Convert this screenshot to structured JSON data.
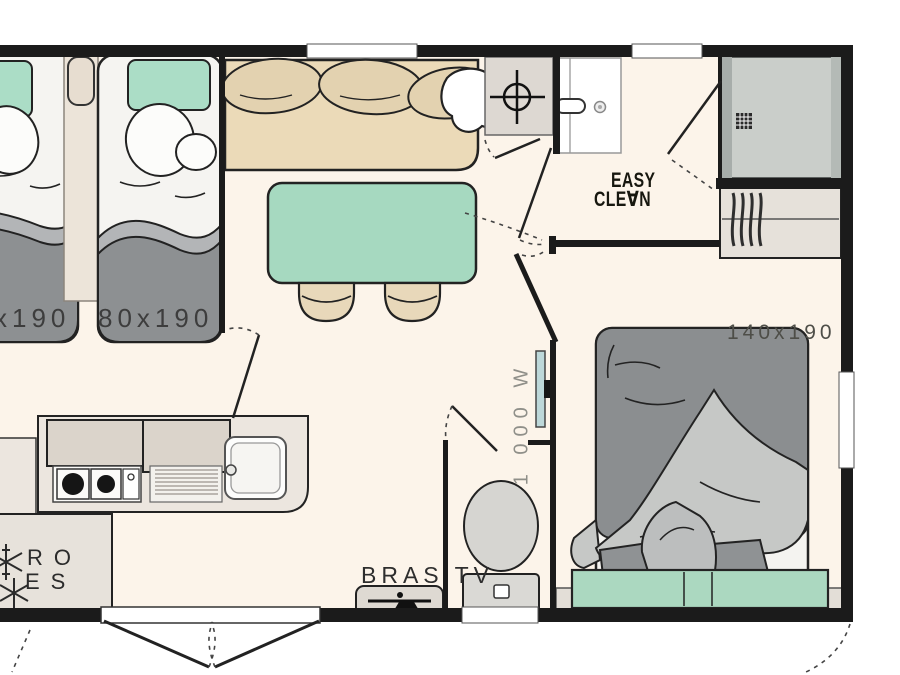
{
  "plan": {
    "title": "mobile-home floor plan",
    "labels": {
      "bed_left_size": "x190",
      "bed_right_size": "80x190",
      "double_bed_size": "140x190",
      "easy_clean_top": "EASY",
      "easy_clean_bottom": "CLE∀N",
      "heater_power": "1 000 W",
      "tv_bracket": "BRAS TV",
      "appliance_line1": "RO",
      "appliance_line2": "ES"
    },
    "colors": {
      "wall": "#1b1b1b",
      "floor": "#fcf4ea",
      "teal": "#a6d9c0",
      "sofa_beige": "#ebdab8",
      "bolster_beige": "#e3d2b0",
      "blanket_gray": "#8d9092",
      "blanket_light": "#b3b5b7",
      "cabinet_beige": "#dbd4cb",
      "wardrobe_beige": "#e6e1da",
      "shower_gray": "#caceca",
      "heater_blue": "#bdd8da"
    }
  }
}
